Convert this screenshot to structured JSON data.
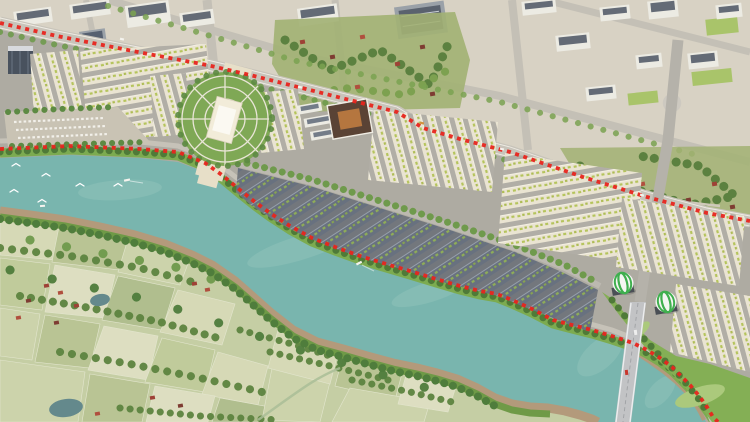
{
  "scene": {
    "description": "Aerial 3D rendering of a riverside township masterplan",
    "regions": {
      "north": "existing city blocks and industrial buildings",
      "boundary": "red dashed project boundary along main road and river bank",
      "center": "rows of cream and slate shophouse blocks",
      "plaza": "circular central plaza with cream boulevard and monument",
      "civic": "courtyard civic building with brown roof",
      "river": "turquoise river with sandy south bank",
      "south": "farmland fields, hedgerows and village houses",
      "bridge": "road bridge crossing the river",
      "domes": "two white-green striped spherical landmarks"
    }
  },
  "palette": {
    "city_ground": "#d8d2c4",
    "city_road": "#c4c0b6",
    "city_building_white": "#ecebe3",
    "city_building_roof": "#646b76",
    "tower_facade": "#49525e",
    "factory_roof": "#5a626e",
    "lawn_green": "#a9c46a",
    "village_green": "#a2b173",
    "tree_dark": "#5c8140",
    "tree_mid": "#6f9a4c",
    "tree_light": "#7aa251",
    "boundary_red": "#e8251d",
    "boundary_road": "#c8c4ba",
    "dev_ground": "#aeaba2",
    "dev_street": "#b1aea6",
    "dev_street_dark": "#73777d",
    "row_light_roof": "#eae4d2",
    "row_light_ridge": "#f6f2e6",
    "row_light_accent": "#b5c45c",
    "row_dark_roof": "#68717f",
    "row_dark_ridge": "#aab2bd",
    "row_dark_accent": "#8fae57",
    "plaza_green": "#7fa855",
    "plaza_path": "#e9e5d7",
    "boulevard_cream": "#e7dfc8",
    "monument_white": "#f2ecd9",
    "civic_roof_brown": "#5a4335",
    "civic_courtyard": "#b5763f",
    "river_teal": "#79b5ae",
    "river_highlight": "#93c5bc",
    "bank_green": "#7cab50",
    "bank_tree": "#4f7a38",
    "bank_sand": "#b39a7b",
    "south_veg": "#6f9a47",
    "south_tree": "#4f7d3c",
    "farm_base": "#c5cea4",
    "field_a": "#d8dab8",
    "field_b": "#b8c493",
    "field_c": "#cdd4ac",
    "field_d": "#c0cb9b",
    "field_e": "#e0e0c4",
    "field_f": "#afbd8d",
    "hedge_green": "#5d8440",
    "creek": "#a9bd96",
    "pond": "#64898c",
    "house_red": "#9e4136",
    "house_red2": "#b04f3e",
    "house_brown": "#7e3c32",
    "park_green": "#84af55",
    "park_lawn": "#abc97c",
    "bridge_deck": "#c2c3c5",
    "bridge_edge": "#ecedee",
    "approach_road": "#b5b2aa",
    "dome_white": "#f4f6f2",
    "dome_green": "#3faf4e",
    "plinth": "#4a4f55",
    "bird_white": "#ffffff",
    "boat_white": "#f5f3ee",
    "car_red": "#c8372d",
    "promenade": "#c9c3b4"
  }
}
